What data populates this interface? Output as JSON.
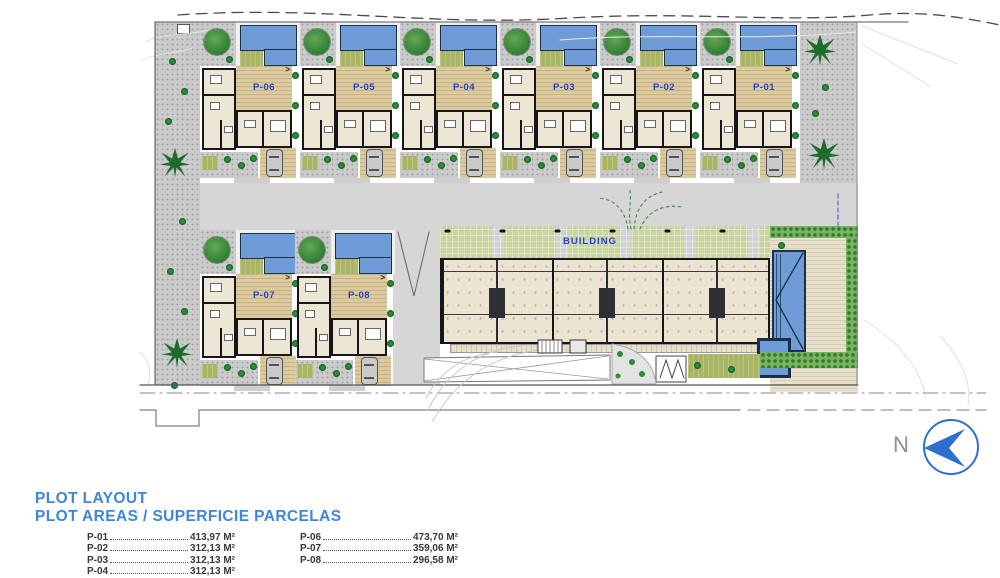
{
  "plan": {
    "building_label": "BUILDING",
    "north_label": "N",
    "deck_arrow": ">",
    "plots": [
      {
        "label": "P-06",
        "x": 200,
        "y": 22
      },
      {
        "label": "P-05",
        "x": 300,
        "y": 22
      },
      {
        "label": "P-04",
        "x": 400,
        "y": 22
      },
      {
        "label": "P-03",
        "x": 500,
        "y": 22
      },
      {
        "label": "P-02",
        "x": 600,
        "y": 22
      },
      {
        "label": "P-01",
        "x": 700,
        "y": 22
      },
      {
        "label": "P-07",
        "x": 200,
        "y": 230
      },
      {
        "label": "P-08",
        "x": 295,
        "y": 230
      }
    ]
  },
  "legend": {
    "title_line1": "PLOT LAYOUT",
    "title_line2": "PLOT AREAS / SUPERFICIE PARCELAS",
    "col1": [
      {
        "plot": "P-01",
        "area": "413,97 M²"
      },
      {
        "plot": "P-02",
        "area": "312,13 M²"
      },
      {
        "plot": "P-03",
        "area": "312,13 M²"
      },
      {
        "plot": "P-04",
        "area": "312,13 M²"
      },
      {
        "plot": "P-05",
        "area": "312,13 M²"
      }
    ],
    "col2": [
      {
        "plot": "P-06",
        "area": "473,70 M²"
      },
      {
        "plot": "P-07",
        "area": "359,06 M²"
      },
      {
        "plot": "P-08",
        "area": "296,58 M²"
      }
    ]
  },
  "colors": {
    "pool": "#6d9cd6",
    "label_blue": "#2640cc",
    "legend_blue": "#3f86d8",
    "lawn": "#a9b465",
    "deck": "#d8c69c",
    "road": "#d6d6d6",
    "north_blue": "#2f6fd0"
  }
}
